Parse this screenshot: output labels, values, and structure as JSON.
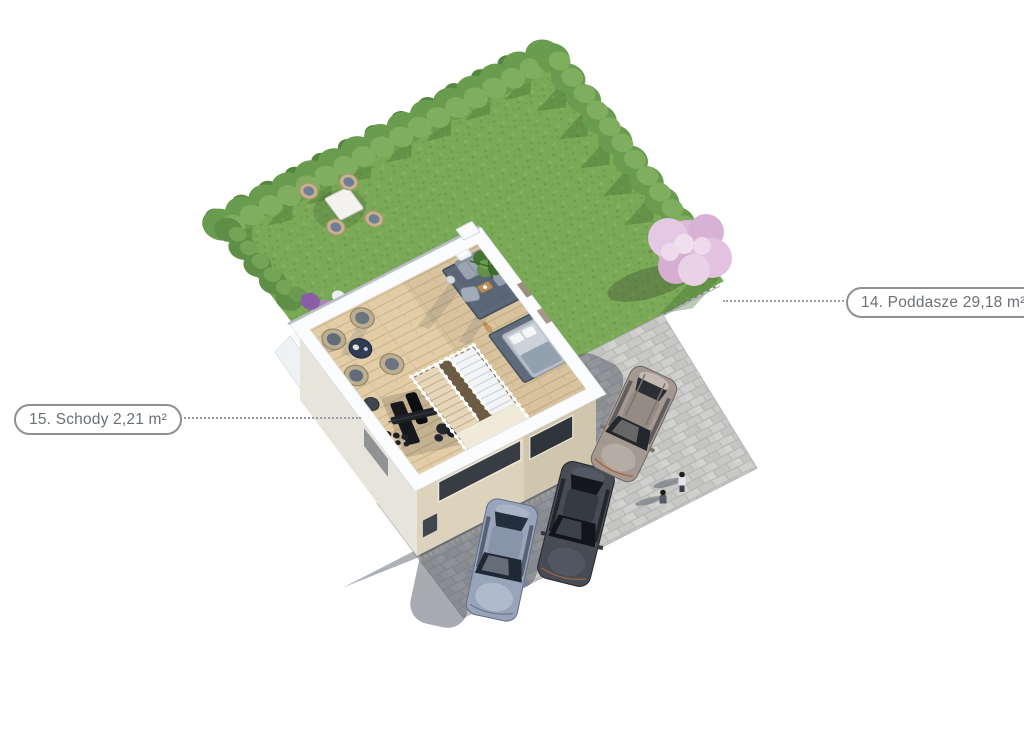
{
  "annotations": {
    "stairs": {
      "label": "15. Schody 2,21 m²"
    },
    "attic": {
      "label": "14. Poddasze 29,18 m²"
    }
  },
  "palette": {
    "background": "#ffffff",
    "lawn": "#7aa957",
    "hedge": "#6a9c4f",
    "blossom_tree": "#dcbada",
    "wood_floor": "#e3cda7",
    "cut_walls": "#fbfcfe",
    "facade": "#ddd3bc",
    "pavement": "#cdcdcb",
    "shadow": "#3d4553",
    "car_blue_gray": "#98a4b9",
    "car_dark": "#474b54",
    "car_taupe": "#a39990",
    "label_border": "#8d9196",
    "label_text": "#6b7075"
  }
}
